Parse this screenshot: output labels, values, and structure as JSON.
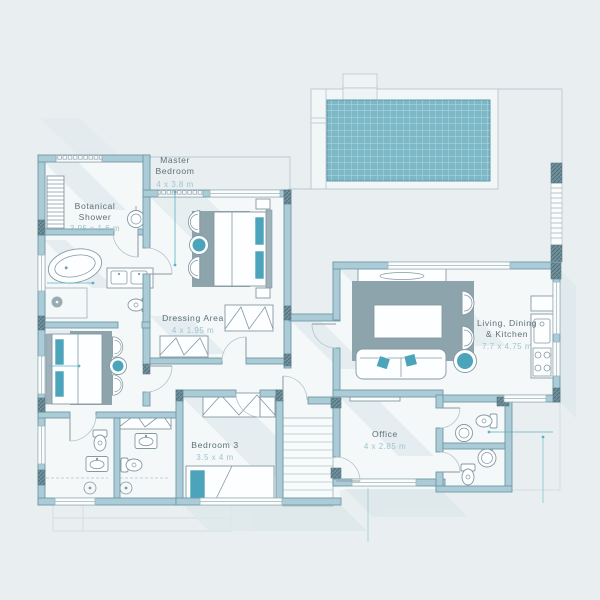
{
  "title": "Villa Floor Plan",
  "colors": {
    "background": "#e9eff1",
    "wall": "#abccd7",
    "wall_outline": "#6e99a7",
    "accent_teal": "#4ba4ba",
    "pool_water": "#7db8c7",
    "rug_gray": "#8da4ac",
    "room_label": "#5d7077",
    "dimension_label": "#9cc4cf"
  },
  "labels": {
    "master_bedroom": {
      "line1": "Master",
      "line2": "Bedroom",
      "dims": "4 x 3.8 m"
    },
    "botanical_shower": {
      "line1": "Botanical",
      "line2": "Shower",
      "dims": "3.95 x 1.6 m"
    },
    "dressing_area": {
      "line1": "Dressing Area",
      "dims": "4 x 1.95 m"
    },
    "living_dining_kitchen": {
      "line1": "Living, Dining",
      "line2": "& Kitchen",
      "dims": "7.7 x 4.75 m"
    },
    "bedroom_3": {
      "line1": "Bedroom 3",
      "dims": "3.5 x 4 m"
    },
    "office": {
      "line1": "Office",
      "dims": "4 x 2.85 m"
    }
  }
}
